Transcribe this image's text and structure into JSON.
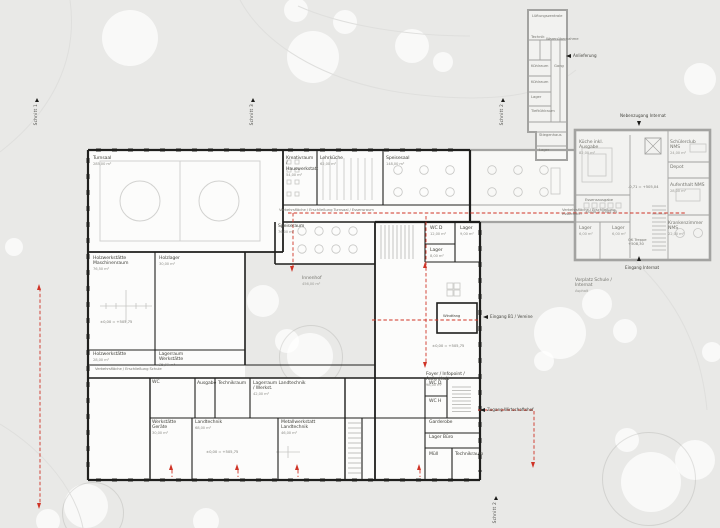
{
  "colors": {
    "background": "#e9e9e7",
    "new_wall": "#1f1f1d",
    "existing_wall": "#a3a3a1",
    "accent_red": "#cf3326",
    "text_dark": "#45453f",
    "text_gray": "#787872"
  },
  "marker_glyph": "up-triangle",
  "section_markers": [
    {
      "label": "Schnitt 1",
      "x": 34,
      "y": 98
    },
    {
      "label": "Schnitt 3",
      "x": 250,
      "y": 98
    },
    {
      "label": "Schnitt 2",
      "x": 500,
      "y": 98
    },
    {
      "label": "Schnitt 2",
      "x": 493,
      "y": 496
    }
  ],
  "labels": [
    {
      "t": "Turnsaal",
      "s": "285,00 m²",
      "x": 93,
      "y": 156
    },
    {
      "t": "Kreativraum / Hauswerkstatt",
      "s": "54,00 m²",
      "x": 286,
      "y": 156,
      "w": 30
    },
    {
      "t": "Lehrküche",
      "s": "62,00 m²",
      "x": 320,
      "y": 156
    },
    {
      "t": "Speisesaal",
      "s": "148,00 m²",
      "x": 386,
      "y": 156
    },
    {
      "t": "Verkehrsfläche / Erschließung Turnsaal / Essensraum",
      "x": 279,
      "y": 208,
      "c": "g",
      "z": "xs"
    },
    {
      "t": "Verkehrsfläche / Erschließung Essbereich",
      "x": 562,
      "y": 208,
      "c": "g",
      "z": "xs",
      "w": 70
    },
    {
      "t": "Speiseraum",
      "s": "76,00 m²",
      "x": 278,
      "y": 224
    },
    {
      "t": "Holzwerkstätte Maschinenraum",
      "s": "76,50 m²",
      "x": 93,
      "y": 256,
      "w": 34
    },
    {
      "t": "Holzlager",
      "s": "30,00 m²",
      "x": 159,
      "y": 256
    },
    {
      "t": "±0,00 = +505,75",
      "x": 100,
      "y": 320,
      "c": "g",
      "z": "xs"
    },
    {
      "t": "Holzwerkstätte",
      "s": "28,00 m²",
      "x": 93,
      "y": 352
    },
    {
      "t": "Lagerraum Werkstätte",
      "s": "35,00 m²",
      "x": 159,
      "y": 352,
      "w": 40
    },
    {
      "t": "Verkehrsfläche / Erschließung Schule",
      "x": 95,
      "y": 367,
      "c": "g",
      "z": "xs"
    },
    {
      "t": "Innenhof",
      "s": "456,00 m²",
      "x": 302,
      "y": 276,
      "c": "g"
    },
    {
      "t": "Windfang",
      "x": 443,
      "y": 314,
      "z": "xs"
    },
    {
      "t": "Foyer / Infopoint / Aufenthalt",
      "s": "98,00 m²",
      "x": 426,
      "y": 372,
      "w": 52
    },
    {
      "t": "±0,00 = +505,75",
      "x": 432,
      "y": 344,
      "c": "g",
      "z": "xs"
    },
    {
      "t": "WC D",
      "s": "12,00 m²",
      "x": 430,
      "y": 226
    },
    {
      "t": "Lager",
      "s": "9,00 m²",
      "x": 460,
      "y": 226
    },
    {
      "t": "Lager",
      "s": "8,00 m²",
      "x": 430,
      "y": 248
    },
    {
      "t": "WC D",
      "x": 429,
      "y": 381
    },
    {
      "t": "WC H",
      "x": 429,
      "y": 399
    },
    {
      "t": "Garderobe",
      "x": 429,
      "y": 420
    },
    {
      "t": "Lager Büro",
      "x": 429,
      "y": 435
    },
    {
      "t": "Müll",
      "x": 429,
      "y": 452
    },
    {
      "t": "Technikraum",
      "x": 455,
      "y": 452,
      "w": 25
    },
    {
      "t": "WC",
      "x": 152,
      "y": 380
    },
    {
      "t": "Ausgabe",
      "x": 197,
      "y": 381,
      "w": 16
    },
    {
      "t": "Technikraum",
      "x": 218,
      "y": 381,
      "w": 28
    },
    {
      "t": "Lagerraum Landtechnik / Werkst.",
      "s": "42,00 m²",
      "x": 253,
      "y": 381,
      "w": 55
    },
    {
      "t": "Werkstätte Geräte",
      "s": "30,00 m²",
      "x": 152,
      "y": 420,
      "w": 30
    },
    {
      "t": "Landtechnik",
      "s": "68,00 m²",
      "x": 195,
      "y": 420
    },
    {
      "t": "Metallwerkstatt Landtechnik",
      "s": "46,00 m²",
      "x": 281,
      "y": 420,
      "w": 44
    },
    {
      "t": "±0,00 = +505,75",
      "x": 206,
      "y": 450,
      "c": "g",
      "z": "xs"
    },
    {
      "t": "Küche inkl. Ausgabe",
      "s": "82,00 m²",
      "x": 579,
      "y": 140,
      "c": "g",
      "w": 40
    },
    {
      "t": "Essensausgabe",
      "x": 585,
      "y": 198,
      "c": "g",
      "z": "xs"
    },
    {
      "t": "±0,00 = +505,75",
      "x": 585,
      "y": 210,
      "c": "g",
      "z": "xs"
    },
    {
      "t": "Lager",
      "s": "6,00 m²",
      "x": 579,
      "y": 226,
      "c": "g"
    },
    {
      "t": "Lager",
      "s": "6,00 m²",
      "x": 612,
      "y": 226,
      "c": "g"
    },
    {
      "t": "-0,71 = +505,04",
      "x": 628,
      "y": 185,
      "c": "g",
      "z": "xs"
    },
    {
      "t": "OK Treppe +508,30",
      "x": 628,
      "y": 238,
      "c": "g",
      "z": "xs",
      "w": 30
    },
    {
      "t": "Schülerclub NMS",
      "s": "24,00 m²",
      "x": 670,
      "y": 140,
      "c": "g",
      "w": 36
    },
    {
      "t": "Depot",
      "x": 670,
      "y": 165,
      "c": "g"
    },
    {
      "t": "Aufenthalt NMS",
      "s": "28,00 m²",
      "x": 670,
      "y": 183,
      "c": "g",
      "w": 36
    },
    {
      "t": "Krankenzimmer NMS",
      "s": "22,00 m²",
      "x": 668,
      "y": 221,
      "c": "g",
      "w": 40
    },
    {
      "t": "Lüftungszentrale",
      "x": 532,
      "y": 14,
      "c": "g",
      "z": "xs",
      "w": 30
    },
    {
      "t": "Technik",
      "x": 531,
      "y": 35,
      "c": "g",
      "z": "xs"
    },
    {
      "t": "Warenübernahme",
      "x": 546,
      "y": 37,
      "c": "g",
      "z": "xs",
      "w": 20
    },
    {
      "t": "Kühlraum",
      "x": 531,
      "y": 64,
      "c": "g",
      "z": "xs"
    },
    {
      "t": "Gang",
      "x": 554,
      "y": 64,
      "c": "g",
      "z": "xs"
    },
    {
      "t": "Kühlraum",
      "x": 531,
      "y": 80,
      "c": "g",
      "z": "xs"
    },
    {
      "t": "Lager",
      "x": 531,
      "y": 95,
      "c": "g",
      "z": "xs"
    },
    {
      "t": "Tiefkühlraum",
      "x": 531,
      "y": 109,
      "c": "g",
      "z": "xs",
      "w": 18
    },
    {
      "t": "Stiegenhaus",
      "x": 539,
      "y": 133,
      "c": "g",
      "z": "xs",
      "w": 22
    },
    {
      "t": "Lager",
      "x": 539,
      "y": 148,
      "c": "g",
      "z": "xs"
    },
    {
      "t": "Vorplatz Schule / Internat",
      "s": "Asphalt",
      "x": 575,
      "y": 278,
      "c": "g",
      "w": 42
    }
  ],
  "arrow_labels": [
    {
      "t": "Anlieferung",
      "x": 573,
      "y": 53,
      "ax": 566,
      "ay": 54,
      "dir": "left"
    },
    {
      "t": "Nebenzugang Internat",
      "x": 620,
      "y": 113,
      "ax": 637,
      "ay": 121,
      "dir": "down"
    },
    {
      "t": "Eingang Internat",
      "x": 625,
      "y": 265,
      "ax": 637,
      "ay": 256,
      "dir": "up"
    },
    {
      "t": "Eingang B1 / Vereine",
      "x": 490,
      "y": 314,
      "ax": 483,
      "ay": 315,
      "dir": "left"
    },
    {
      "t": "Zugang Wirtschaftshof",
      "x": 487,
      "y": 407,
      "ax": 480,
      "ay": 408,
      "dir": "left"
    }
  ],
  "red_arrows": [
    {
      "x": 40,
      "y": 284,
      "dir": "up"
    },
    {
      "x": 40,
      "y": 503,
      "dir": "down"
    },
    {
      "x": 293,
      "y": 266,
      "dir": "down"
    },
    {
      "x": 426,
      "y": 262,
      "dir": "up"
    },
    {
      "x": 426,
      "y": 362,
      "dir": "down"
    },
    {
      "x": 172,
      "y": 464,
      "dir": "up"
    },
    {
      "x": 238,
      "y": 464,
      "dir": "up"
    },
    {
      "x": 298,
      "y": 464,
      "dir": "up"
    },
    {
      "x": 420,
      "y": 464,
      "dir": "up"
    },
    {
      "x": 534,
      "y": 462,
      "dir": "down"
    }
  ],
  "trees": [
    {
      "x": 130,
      "y": 38,
      "r": 28
    },
    {
      "x": 313,
      "y": 57,
      "r": 26
    },
    {
      "x": 345,
      "y": 22,
      "r": 12
    },
    {
      "x": 296,
      "y": 10,
      "r": 12
    },
    {
      "x": 412,
      "y": 46,
      "r": 17
    },
    {
      "x": 443,
      "y": 62,
      "r": 10
    },
    {
      "x": 540,
      "y": 84,
      "r": 11
    },
    {
      "x": 700,
      "y": 79,
      "r": 16
    },
    {
      "x": 226,
      "y": 291,
      "r": 11
    },
    {
      "x": 263,
      "y": 301,
      "r": 16
    },
    {
      "x": 310,
      "y": 356,
      "r": 23
    },
    {
      "x": 287,
      "y": 341,
      "r": 12
    },
    {
      "x": 560,
      "y": 333,
      "r": 26
    },
    {
      "x": 597,
      "y": 304,
      "r": 15
    },
    {
      "x": 625,
      "y": 331,
      "r": 12
    },
    {
      "x": 544,
      "y": 361,
      "r": 10
    },
    {
      "x": 651,
      "y": 482,
      "r": 30
    },
    {
      "x": 695,
      "y": 460,
      "r": 20
    },
    {
      "x": 627,
      "y": 440,
      "r": 12
    },
    {
      "x": 86,
      "y": 506,
      "r": 22
    },
    {
      "x": 48,
      "y": 521,
      "r": 12
    },
    {
      "x": 206,
      "y": 521,
      "r": 13
    },
    {
      "x": 712,
      "y": 352,
      "r": 10
    },
    {
      "x": 14,
      "y": 247,
      "r": 9
    },
    {
      "x": 648,
      "y": 478,
      "r": 46,
      "ring": true
    },
    {
      "x": 92,
      "y": 512,
      "r": 30,
      "ring": true
    },
    {
      "x": 310,
      "y": 356,
      "r": 31,
      "ring": true
    }
  ]
}
